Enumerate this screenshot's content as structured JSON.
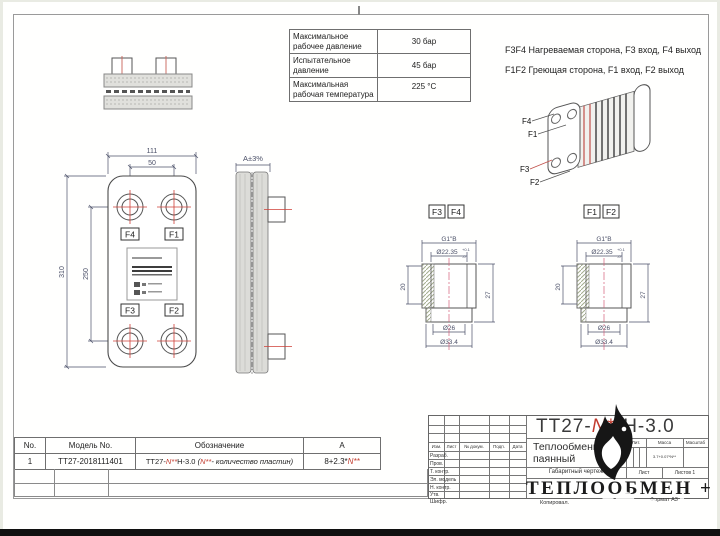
{
  "colors": {
    "red": "#c23b2e",
    "dim": "#4b5068",
    "line": "#555555"
  },
  "spec_table": {
    "rows": [
      {
        "label": "Максимальное рабочее давление",
        "value": "30 бар"
      },
      {
        "label": "Испытательное давление",
        "value": "45 бар"
      },
      {
        "label": "Максимальная рабочая температура",
        "value": "225 °C"
      }
    ]
  },
  "notes": {
    "line1": "F3F4 Нагреваемая сторона, F3 вход, F4 выход",
    "line2": "F1F2 Греющая сторона, F1 вход, F2 выход"
  },
  "iso_view": {
    "f4": "F4",
    "f1": "F1",
    "f3": "F3",
    "f2": "F2"
  },
  "front_view": {
    "dim_width": "111",
    "dim_port_span": "50",
    "dim_height": "310",
    "dim_port_height": "250",
    "port_tl": "F4",
    "port_tr": "F1",
    "port_bl": "F3",
    "port_br": "F2"
  },
  "side_view": {
    "dim": "A±3%"
  },
  "sections": [
    {
      "tag1": "F3",
      "tag2": "F4",
      "thread": "G1\"B",
      "bore": "Ø22.35",
      "tol_up": "+0.1",
      "tol_dn": "-0",
      "depth": "20",
      "height": "27",
      "dia_mid": "Ø26",
      "dia_out": "Ø33.4"
    },
    {
      "tag1": "F1",
      "tag2": "F2",
      "thread": "G1\"B",
      "bore": "Ø22.35",
      "tol_up": "+0.1",
      "tol_dn": "-0",
      "depth": "20",
      "height": "27",
      "dia_mid": "Ø26",
      "dia_out": "Ø33.4"
    }
  ],
  "parts_table": {
    "headers": {
      "no": "No.",
      "model": "Модель No.",
      "designation": "Обозначение",
      "a": "A"
    },
    "row": {
      "no": "1",
      "model": "ТТ27-2018111401",
      "d1": "ТТ27-",
      "d2": "N**",
      "d3": "H-3.0",
      "d4": "(",
      "d5": "N**",
      "d6": "- количество пластин)",
      "a1": "8+2.3*",
      "a2": "N**"
    }
  },
  "title_block": {
    "designation": {
      "p1": "ТТ27-",
      "p2": "N**",
      "p3": "H-3.0"
    },
    "doc_line1": "Теплообменник",
    "doc_line2": "паянный",
    "doc_type": "Габаритный чертеж",
    "lit": "Лит.",
    "mass": "Масса",
    "scale": "Масштаб",
    "mass_value": "3.7+0.07*N**",
    "sheet": "Лист",
    "sheets": "Листов 1",
    "company": "ТЕПЛООБМЕН +",
    "h_izm": "Изм.",
    "h_list": "Лист",
    "h_doc": "№ докум.",
    "h_podp": "Подп.",
    "h_data": "Дата",
    "r1": "Разраб.",
    "r2": "Пров.",
    "r3": "Т. контр.",
    "r4": "Эл. модель",
    "r5": "Н. контр.",
    "r6": "Утв.",
    "cipher": "Шифр.",
    "copied": "Копировал.",
    "format": "Формат А3"
  },
  "watermark": {
    "text": "Avito"
  }
}
